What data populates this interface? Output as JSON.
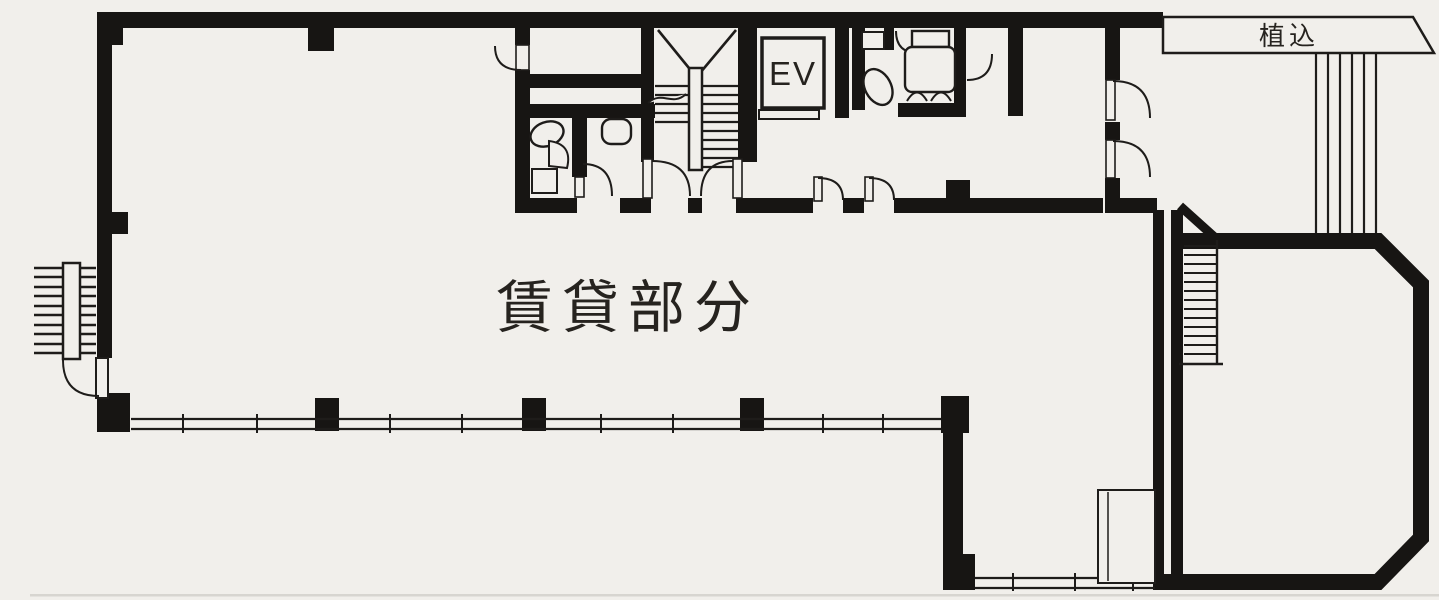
{
  "labels": {
    "rental_area": "賃貸部分",
    "elevator": "EV",
    "planting": "植込"
  },
  "colors": {
    "paper": "#f1efeb",
    "wall": "#171513",
    "line": "#1e1c1a",
    "text": "#26231f"
  }
}
